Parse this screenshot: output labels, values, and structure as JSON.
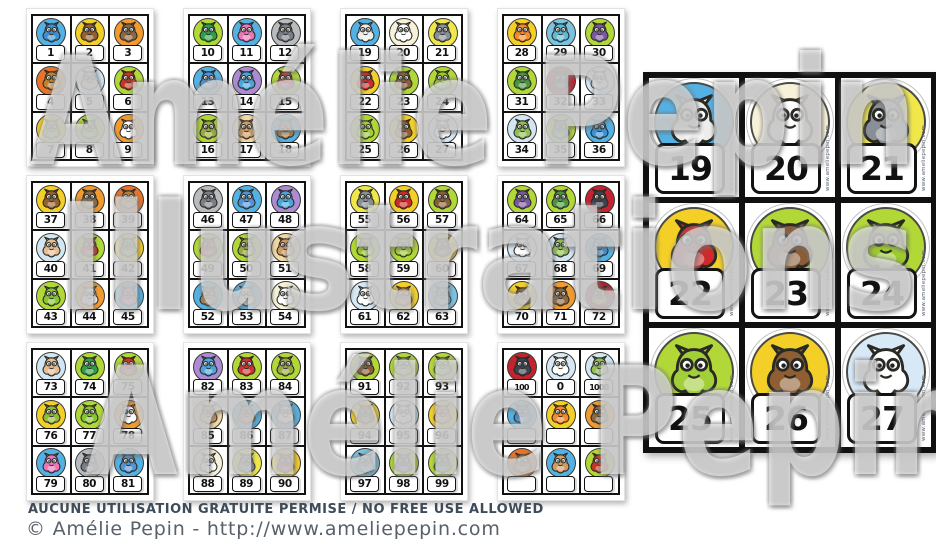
{
  "watermark": {
    "line1": "Amélie Pepin",
    "line2": "Illustrations",
    "line3": "Amélie Pepin"
  },
  "footer": {
    "notice": "AUCUNE UTILISATION GRATUITE PERMISE / NO FREE USE ALLOWED",
    "credit": "© Amélie Pepin - http://www.ameliepepin.com"
  },
  "preview": {
    "source_sheet_index": 2,
    "url_text": "www.ameliepepin.com"
  },
  "colors": {
    "grid_line": "#121212",
    "paper": "#ffffff",
    "notice_text": "#3e4b59",
    "credit_text": "#596069"
  },
  "sheets": [
    {
      "cards": [
        {
          "n": "1",
          "c": "sea-serpent",
          "bg": "#54b1e4",
          "body": "#3f8fd0"
        },
        {
          "n": "2",
          "c": "centaur",
          "bg": "#f3cf27",
          "body": "#94602f"
        },
        {
          "n": "3",
          "c": "boar",
          "bg": "#f09a30",
          "body": "#8a6845"
        },
        {
          "n": "4",
          "c": "lion",
          "bg": "#e8742c",
          "body": "#c08030"
        },
        {
          "n": "5",
          "c": "cyclops",
          "bg": "#d3e6f4",
          "body": "#e6bd92"
        },
        {
          "n": "6",
          "c": "red-dragon",
          "bg": "#b2d838",
          "body": "#c63624"
        },
        {
          "n": "7",
          "c": "elf",
          "bg": "#f3cf27",
          "body": "#8fba3a"
        },
        {
          "n": "8",
          "c": "alien",
          "bg": "#b2d838",
          "body": "#85c52f"
        },
        {
          "n": "9",
          "c": "ghost",
          "bg": "#f09a30",
          "body": "#ffffff"
        }
      ]
    },
    {
      "cards": [
        {
          "n": "10",
          "c": "leprechaun",
          "bg": "#b2d838",
          "body": "#2f9e49"
        },
        {
          "n": "11",
          "c": "fairy",
          "bg": "#54b1e4",
          "body": "#ea76b8"
        },
        {
          "n": "12",
          "c": "gargoyle",
          "bg": "#b8bcc1",
          "body": "#7a7f87"
        },
        {
          "n": "13",
          "c": "princess",
          "bg": "#54b1e4",
          "body": "#5093d6"
        },
        {
          "n": "14",
          "c": "genie",
          "bg": "#ad8bd4",
          "body": "#49a5da"
        },
        {
          "n": "15",
          "c": "gnome",
          "bg": "#b2d838",
          "body": "#cb3434"
        },
        {
          "n": "16",
          "c": "troll",
          "bg": "#b2d838",
          "body": "#97a93f"
        },
        {
          "n": "17",
          "c": "giant",
          "bg": "#f2d8a4",
          "body": "#d09a60"
        },
        {
          "n": "18",
          "c": "griffin",
          "bg": "#54b1e4",
          "body": "#a87f4d"
        }
      ]
    },
    {
      "cards": [
        {
          "n": "19",
          "c": "hippogriff",
          "bg": "#54b1e4",
          "body": "#ededed"
        },
        {
          "n": "20",
          "c": "unicorn",
          "bg": "#f6f1d8",
          "body": "#ffffff"
        },
        {
          "n": "21",
          "c": "werewolf",
          "bg": "#f0e84a",
          "body": "#898f96"
        },
        {
          "n": "22",
          "c": "wizard",
          "bg": "#f3cf27",
          "body": "#cd2b2b"
        },
        {
          "n": "23",
          "c": "minotaur",
          "bg": "#b2d838",
          "body": "#8a5c37"
        },
        {
          "n": "24",
          "c": "green-monster",
          "bg": "#b2d838",
          "body": "#9ccb2e"
        },
        {
          "n": "25",
          "c": "ogre",
          "bg": "#b2d838",
          "body": "#a2ce3a"
        },
        {
          "n": "26",
          "c": "faun",
          "bg": "#f3cf27",
          "body": "#8f5f33"
        },
        {
          "n": "27",
          "c": "pegasus",
          "bg": "#d7e8f6",
          "body": "#ffffff"
        }
      ]
    },
    {
      "cards": [
        {
          "n": "28",
          "c": "phoenix",
          "bg": "#f3cf27",
          "body": "#f28a2a"
        },
        {
          "n": "29",
          "c": "mermaid",
          "bg": "#7cc3e2",
          "body": "#5fbad4"
        },
        {
          "n": "30",
          "c": "witch",
          "bg": "#b2d838",
          "body": "#7a57a2"
        },
        {
          "n": "31",
          "c": "swamp-monster",
          "bg": "#b2d838",
          "body": "#4c9341"
        },
        {
          "n": "32",
          "c": "vampire",
          "bg": "#c2232e",
          "body": "#3d404d"
        },
        {
          "n": "33",
          "c": "yeti",
          "bg": "#d7e8f6",
          "body": "#ffffff"
        },
        {
          "n": "34",
          "c": "zombie",
          "bg": "#d3e6f4",
          "body": "#8fbf50"
        },
        {
          "n": "35",
          "c": "leprechaun",
          "bg": "#b2d838",
          "body": "#2f9e49"
        },
        {
          "n": "36",
          "c": "sea-serpent",
          "bg": "#54b1e4",
          "body": "#3f8fd0"
        }
      ]
    },
    {
      "cards": [
        {
          "n": "37",
          "c": "centaur",
          "bg": "#f3cf27",
          "body": "#94602f"
        },
        {
          "n": "38",
          "c": "boar",
          "bg": "#f09a30",
          "body": "#8a6845"
        },
        {
          "n": "39",
          "c": "lion",
          "bg": "#e8742c",
          "body": "#c08030"
        },
        {
          "n": "40",
          "c": "cyclops",
          "bg": "#d3e6f4",
          "body": "#e6bd92"
        },
        {
          "n": "41",
          "c": "red-dragon",
          "bg": "#b2d838",
          "body": "#c63624"
        },
        {
          "n": "42",
          "c": "elf",
          "bg": "#f3cf27",
          "body": "#8fba3a"
        },
        {
          "n": "43",
          "c": "alien",
          "bg": "#b2d838",
          "body": "#85c52f"
        },
        {
          "n": "44",
          "c": "ghost",
          "bg": "#f09a30",
          "body": "#ffffff"
        },
        {
          "n": "45",
          "c": "fairy",
          "bg": "#54b1e4",
          "body": "#ea76b8"
        }
      ]
    },
    {
      "cards": [
        {
          "n": "46",
          "c": "gargoyle",
          "bg": "#b8bcc1",
          "body": "#7a7f87"
        },
        {
          "n": "47",
          "c": "princess",
          "bg": "#54b1e4",
          "body": "#5093d6"
        },
        {
          "n": "48",
          "c": "genie",
          "bg": "#ad8bd4",
          "body": "#49a5da"
        },
        {
          "n": "49",
          "c": "gnome",
          "bg": "#b2d838",
          "body": "#cb3434"
        },
        {
          "n": "50",
          "c": "troll",
          "bg": "#b2d838",
          "body": "#97a93f"
        },
        {
          "n": "51",
          "c": "giant",
          "bg": "#f2d8a4",
          "body": "#d09a60"
        },
        {
          "n": "52",
          "c": "griffin",
          "bg": "#54b1e4",
          "body": "#a87f4d"
        },
        {
          "n": "53",
          "c": "hippogriff",
          "bg": "#54b1e4",
          "body": "#ededed"
        },
        {
          "n": "54",
          "c": "unicorn",
          "bg": "#f6f1d8",
          "body": "#ffffff"
        }
      ]
    },
    {
      "cards": [
        {
          "n": "55",
          "c": "werewolf",
          "bg": "#f0e84a",
          "body": "#898f96"
        },
        {
          "n": "56",
          "c": "wizard",
          "bg": "#f3cf27",
          "body": "#cd2b2b"
        },
        {
          "n": "57",
          "c": "minotaur",
          "bg": "#b2d838",
          "body": "#8a5c37"
        },
        {
          "n": "58",
          "c": "green-monster",
          "bg": "#b2d838",
          "body": "#9ccb2e"
        },
        {
          "n": "59",
          "c": "ogre",
          "bg": "#b2d838",
          "body": "#a2ce3a"
        },
        {
          "n": "60",
          "c": "faun",
          "bg": "#f3cf27",
          "body": "#8f5f33"
        },
        {
          "n": "61",
          "c": "pegasus",
          "bg": "#d7e8f6",
          "body": "#ffffff"
        },
        {
          "n": "62",
          "c": "phoenix",
          "bg": "#f3cf27",
          "body": "#f28a2a"
        },
        {
          "n": "63",
          "c": "mermaid",
          "bg": "#7cc3e2",
          "body": "#5fbad4"
        }
      ]
    },
    {
      "cards": [
        {
          "n": "64",
          "c": "witch",
          "bg": "#b2d838",
          "body": "#7a57a2"
        },
        {
          "n": "65",
          "c": "swamp-monster",
          "bg": "#b2d838",
          "body": "#4c9341"
        },
        {
          "n": "66",
          "c": "vampire",
          "bg": "#c2232e",
          "body": "#3d404d"
        },
        {
          "n": "67",
          "c": "yeti",
          "bg": "#d7e8f6",
          "body": "#ffffff"
        },
        {
          "n": "68",
          "c": "zombie",
          "bg": "#d3e6f4",
          "body": "#8fbf50"
        },
        {
          "n": "69",
          "c": "sea-serpent",
          "bg": "#54b1e4",
          "body": "#3f8fd0"
        },
        {
          "n": "70",
          "c": "centaur",
          "bg": "#f3cf27",
          "body": "#94602f"
        },
        {
          "n": "71",
          "c": "boar",
          "bg": "#f09a30",
          "body": "#8a6845"
        },
        {
          "n": "72",
          "c": "lion",
          "bg": "#ab2430",
          "body": "#c08030"
        }
      ]
    },
    {
      "cards": [
        {
          "n": "73",
          "c": "cyclops",
          "bg": "#d3e6f4",
          "body": "#e6bd92"
        },
        {
          "n": "74",
          "c": "leprechaun",
          "bg": "#b2d838",
          "body": "#2f9e49"
        },
        {
          "n": "75",
          "c": "red-dragon",
          "bg": "#b2d838",
          "body": "#c63624"
        },
        {
          "n": "76",
          "c": "elf",
          "bg": "#f3cf27",
          "body": "#8fba3a"
        },
        {
          "n": "77",
          "c": "alien",
          "bg": "#b2d838",
          "body": "#85c52f"
        },
        {
          "n": "78",
          "c": "ghost",
          "bg": "#f09a30",
          "body": "#ffffff"
        },
        {
          "n": "79",
          "c": "fairy",
          "bg": "#54b1e4",
          "body": "#ea76b8"
        },
        {
          "n": "80",
          "c": "gargoyle",
          "bg": "#b8bcc1",
          "body": "#7a7f87"
        },
        {
          "n": "81",
          "c": "princess",
          "bg": "#54b1e4",
          "body": "#5093d6"
        }
      ]
    },
    {
      "cards": [
        {
          "n": "82",
          "c": "genie",
          "bg": "#ad8bd4",
          "body": "#49a5da"
        },
        {
          "n": "83",
          "c": "gnome",
          "bg": "#b2d838",
          "body": "#cb3434"
        },
        {
          "n": "84",
          "c": "troll",
          "bg": "#b2d838",
          "body": "#97a93f"
        },
        {
          "n": "85",
          "c": "giant",
          "bg": "#f2d8a4",
          "body": "#d09a60"
        },
        {
          "n": "86",
          "c": "griffin",
          "bg": "#54b1e4",
          "body": "#a87f4d"
        },
        {
          "n": "87",
          "c": "hippogriff",
          "bg": "#54b1e4",
          "body": "#ededed"
        },
        {
          "n": "88",
          "c": "unicorn",
          "bg": "#f6f1d8",
          "body": "#ffffff"
        },
        {
          "n": "89",
          "c": "werewolf",
          "bg": "#f0e84a",
          "body": "#898f96"
        },
        {
          "n": "90",
          "c": "wizard",
          "bg": "#f3cf27",
          "body": "#cd2b2b"
        }
      ]
    },
    {
      "cards": [
        {
          "n": "91",
          "c": "minotaur",
          "bg": "#b2d838",
          "body": "#8a5c37"
        },
        {
          "n": "92",
          "c": "green-monster",
          "bg": "#b2d838",
          "body": "#9ccb2e"
        },
        {
          "n": "93",
          "c": "ogre",
          "bg": "#b2d838",
          "body": "#a2ce3a"
        },
        {
          "n": "94",
          "c": "faun",
          "bg": "#f3cf27",
          "body": "#8f5f33"
        },
        {
          "n": "95",
          "c": "pegasus",
          "bg": "#d7e8f6",
          "body": "#ffffff"
        },
        {
          "n": "96",
          "c": "phoenix",
          "bg": "#f3cf27",
          "body": "#f28a2a"
        },
        {
          "n": "97",
          "c": "mermaid",
          "bg": "#7cc3e2",
          "body": "#5fbad4"
        },
        {
          "n": "98",
          "c": "witch",
          "bg": "#b2d838",
          "body": "#7a57a2"
        },
        {
          "n": "99",
          "c": "swamp-monster",
          "bg": "#b2d838",
          "body": "#4c9341"
        }
      ]
    },
    {
      "cards": [
        {
          "n": "100",
          "c": "vampire",
          "bg": "#c2232e",
          "body": "#3d404d"
        },
        {
          "n": "0",
          "c": "yeti",
          "bg": "#d7e8f6",
          "body": "#ffffff"
        },
        {
          "n": "1000",
          "c": "zombie",
          "bg": "#d3e6f4",
          "body": "#8fbf50"
        },
        {
          "n": "",
          "c": "sea-serpent",
          "bg": "#54b1e4",
          "body": "#3f8fd0"
        },
        {
          "n": "",
          "c": "phoenix",
          "bg": "#f3cf27",
          "body": "#f28a2a"
        },
        {
          "n": "",
          "c": "boar",
          "bg": "#f09a30",
          "body": "#8a6845"
        },
        {
          "n": "",
          "c": "lion",
          "bg": "#e8742c",
          "body": "#c08030"
        },
        {
          "n": "",
          "c": "cyclops",
          "bg": "#54b1e4",
          "body": "#d09a60"
        },
        {
          "n": "",
          "c": "red-dragon",
          "bg": "#b2d838",
          "body": "#c63624"
        }
      ]
    }
  ]
}
